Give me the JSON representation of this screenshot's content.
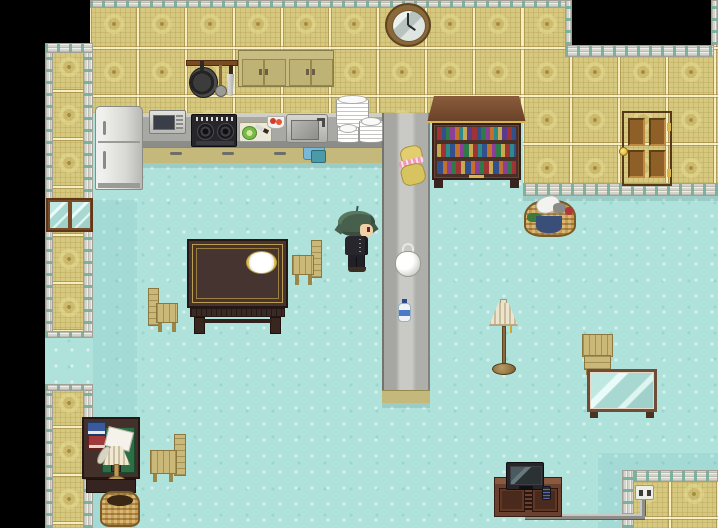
{
  "game": {
    "title": "Top-down RPG interior (kitchen and living room)",
    "character": {
      "label": "Player character with messy green hair and dark school uniform, facing right",
      "hair_color": "#47604e",
      "uniform_color": "#26262c",
      "facing": "right"
    },
    "palette": {
      "outside": "#000000",
      "floor": "#b0e2dc",
      "wallpaper": "#d6c87e",
      "wall_trim": "#d4d4cc",
      "trim_accent": "#6eaa96",
      "counter_top": "#a8a8a4",
      "counter_base": "#c5b87b",
      "wood_dark": "#44302a",
      "wood_light": "#c9b878",
      "door_wood": "#96661f"
    },
    "objects": {
      "clock": {
        "label": "Round wall clock"
      },
      "pot_rack": {
        "label": "Hanging rack with frying pan, skimmer and knife"
      },
      "cabinets": {
        "label": "Upper kitchen cabinets"
      },
      "fridge": {
        "label": "Refrigerator"
      },
      "microwave": {
        "label": "Microwave oven"
      },
      "stove": {
        "label": "Gas cooktop"
      },
      "cutting_board": {
        "label": "Cutting board with lettuce and knife"
      },
      "tomato_bowl": {
        "label": "Bowl of tomatoes"
      },
      "sink": {
        "label": "Kitchen sink with faucet"
      },
      "plates": {
        "label": "Stacks of white plates"
      },
      "towel": {
        "label": "Blue hand towel on counter"
      },
      "dish_bin": {
        "label": "Blue dish bin"
      },
      "counter": {
        "label": "Kitchen counter"
      },
      "peninsula": {
        "label": "Counter peninsula"
      },
      "doll": {
        "label": "Yellow plush doll on counter"
      },
      "plastic_bag": {
        "label": "White plastic bag"
      },
      "water_bottle": {
        "label": "Water bottle"
      },
      "bookshelf": {
        "label": "Bookshelf full of colored books"
      },
      "laundry_basket": {
        "label": "Laundry basket with clothes"
      },
      "door": {
        "label": "Wooden panel door"
      },
      "window": {
        "label": "Window in left wall"
      },
      "opening": {
        "label": "Passage opening in left wall"
      },
      "dining_table": {
        "label": "Dining table with a plate"
      },
      "table_plate": {
        "label": "White plate"
      },
      "chair_left": {
        "label": "Wooden chair facing right"
      },
      "chair_right": {
        "label": "Wooden chair facing left"
      },
      "chair_desk": {
        "label": "Wooden chair by the desk"
      },
      "chair_case": {
        "label": "Wooden chair by the glass table"
      },
      "floor_lamp": {
        "label": "Floor lamp with pleated shade"
      },
      "glass_case": {
        "label": "Glass display table"
      },
      "tv_stand": {
        "label": "TV cabinet"
      },
      "tv": {
        "label": "Television set"
      },
      "remote": {
        "label": "Remote control"
      },
      "outlet": {
        "label": "Wall power outlet"
      },
      "cable": {
        "label": "Power cable"
      },
      "desk": {
        "label": "Writing desk with lamp, books, quill and letters"
      },
      "wastebasket": {
        "label": "Wicker wastebasket"
      }
    }
  }
}
